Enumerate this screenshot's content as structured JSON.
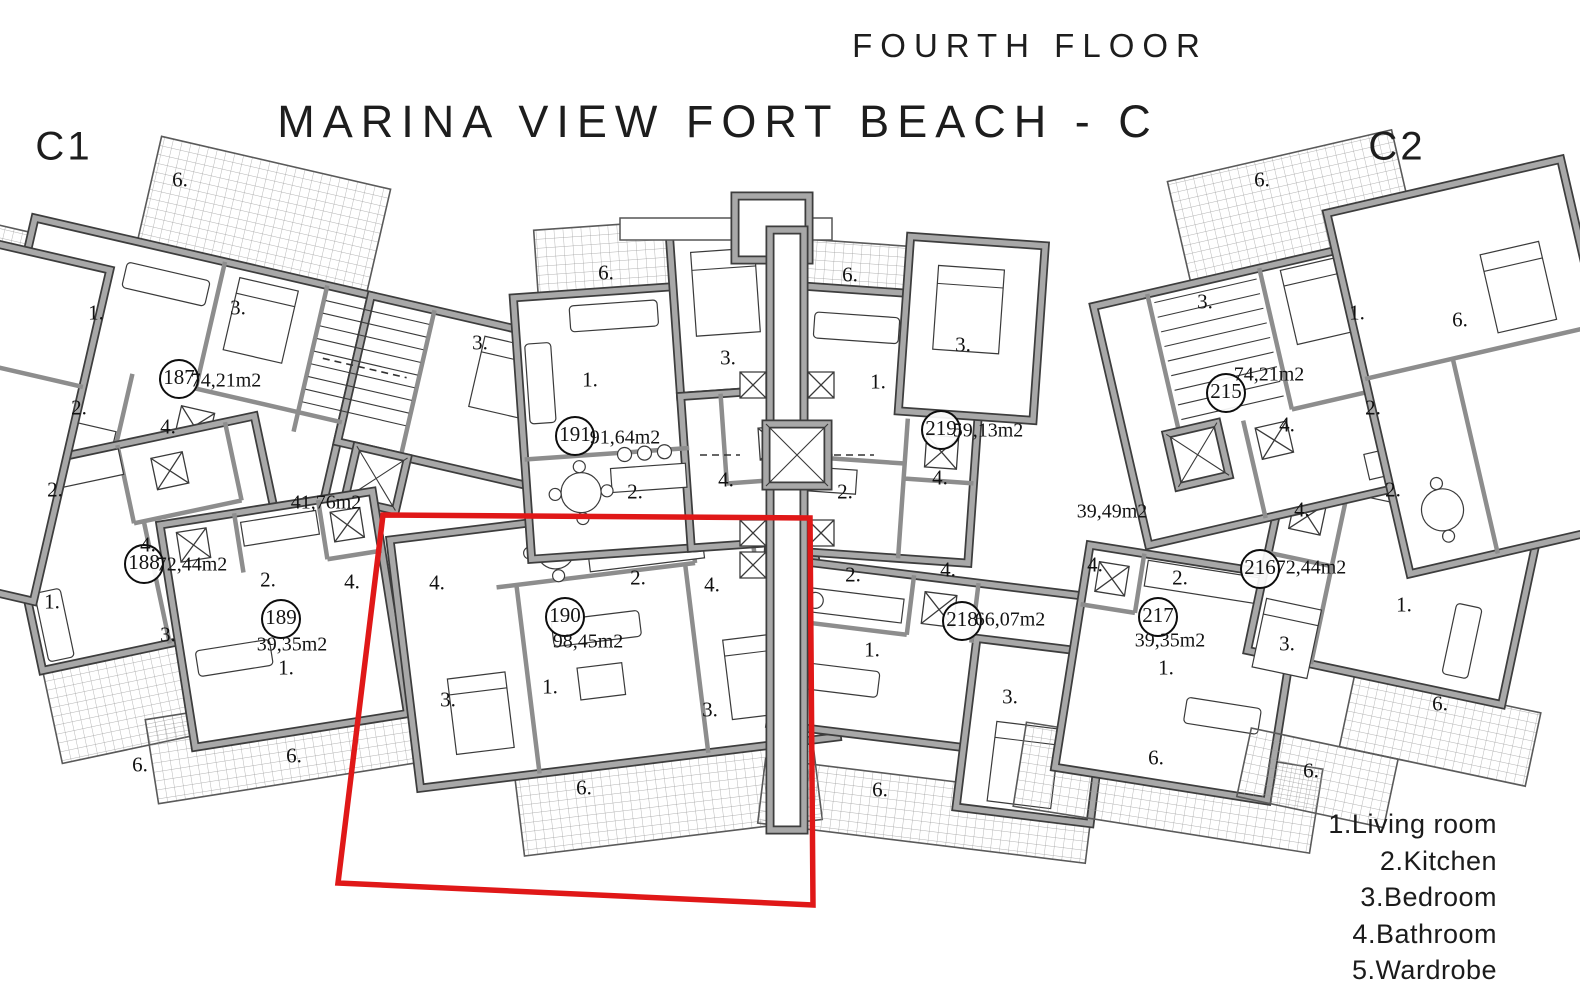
{
  "header": {
    "floor_label": "FOURTH FLOOR",
    "project_title": "MARINA VIEW FORT BEACH - C",
    "section_left": "C1",
    "section_right": "C2"
  },
  "apartments": [
    {
      "num": "187",
      "area": "74,21m2"
    },
    {
      "num": "188",
      "area": "72,44m2"
    },
    {
      "num": "189",
      "area": "39,35m2"
    },
    {
      "num": "190",
      "area": "98,45m2"
    },
    {
      "num": "191",
      "area": "91,64m2"
    },
    {
      "num": "215",
      "area": "74,21m2"
    },
    {
      "num": "216",
      "area": "72,44m2"
    },
    {
      "num": "217",
      "area": "39,35m2"
    },
    {
      "num": "218",
      "area": "66,07m2"
    },
    {
      "num": "219",
      "area": "59,13m2"
    }
  ],
  "common_areas": {
    "left": "41,76m2",
    "right": "39,49m2"
  },
  "rooms": [
    "1.",
    "3.",
    "2.",
    "4.",
    "2.",
    "4.",
    "1.",
    "3.",
    "6.",
    "6.",
    "2.",
    "1.",
    "3.",
    "6.",
    "3.",
    "6.",
    "6.",
    "3.",
    "1.",
    "2.",
    "4.",
    "2.",
    "4.",
    "1.",
    "3.",
    "6.",
    "3.",
    "1.",
    "2.",
    "4.",
    "2.",
    "4.",
    "1.",
    "3.",
    "6.",
    "3.",
    "1.",
    "4.",
    "2.",
    "2.",
    "4.",
    "4.",
    "2.",
    "1.",
    "3.",
    "6.",
    "6.",
    "1.",
    "6.",
    "6.",
    "6.",
    "4.",
    "4."
  ],
  "legend": {
    "items": [
      "1.Living room",
      "2.Kitchen",
      "3.Bedroom",
      "4.Bathroom",
      "5.Wardrobe"
    ]
  },
  "highlight": {
    "apartment": "190",
    "color": "#e01818"
  }
}
